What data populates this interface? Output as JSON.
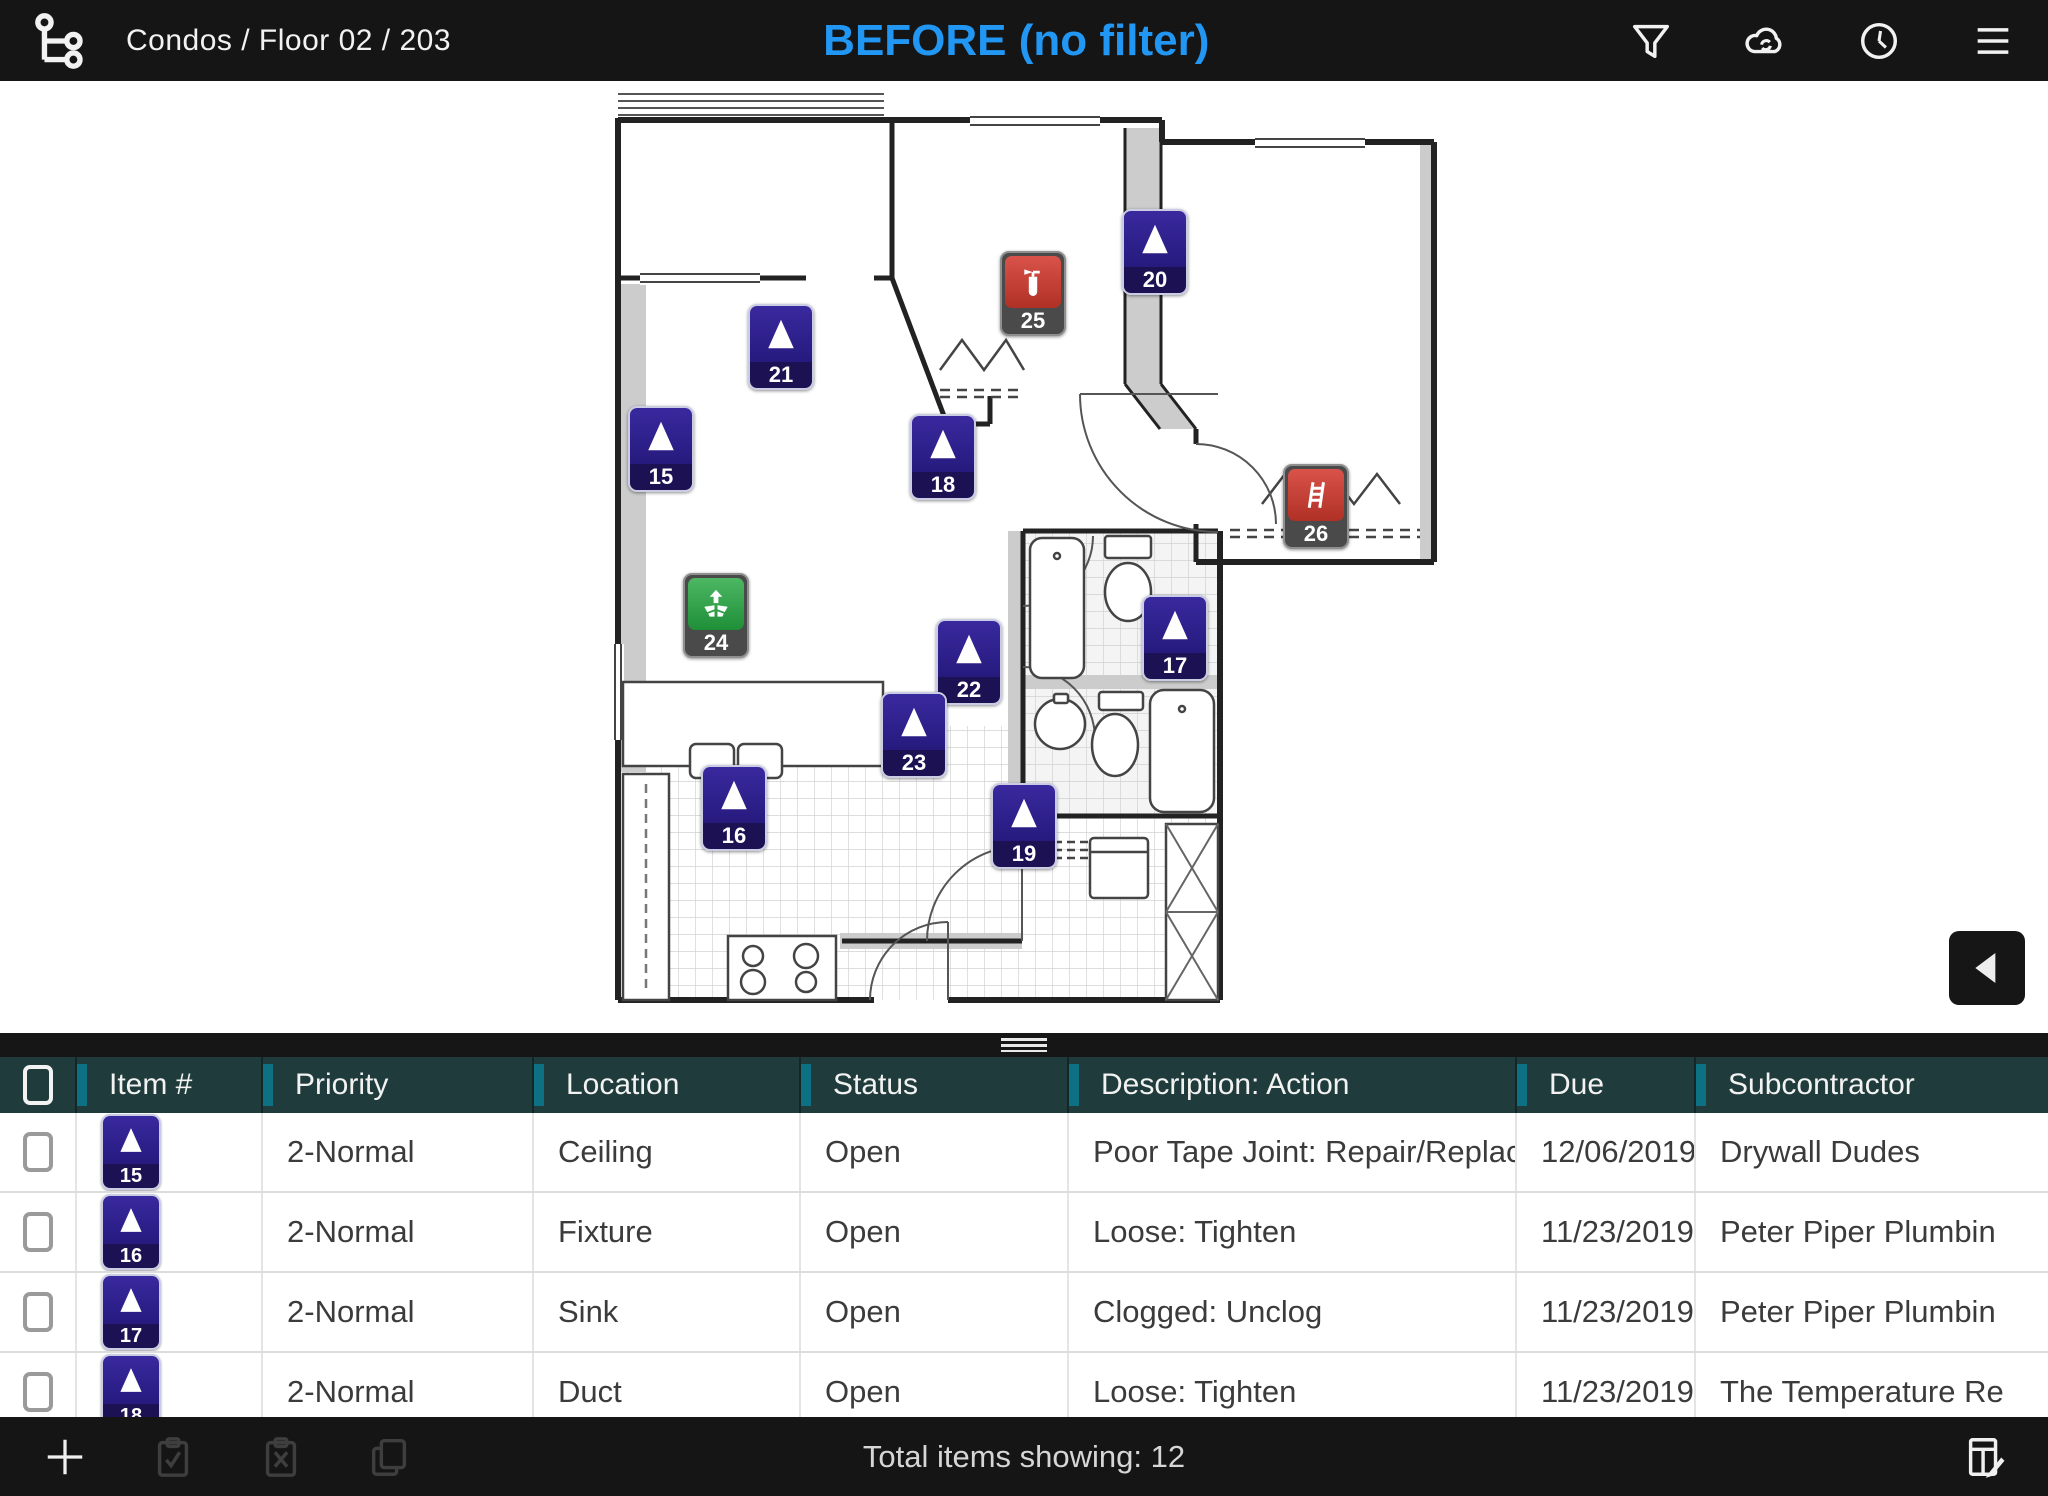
{
  "header": {
    "breadcrumb": "Condos / Floor 02 / 203",
    "title": "BEFORE (no filter)",
    "icons": [
      "hierarchy-icon",
      "filter-icon",
      "cloud-sync-icon",
      "history-icon",
      "menu-icon"
    ]
  },
  "colors": {
    "accent": "#2196f3",
    "header_bg": "#1f3b3b",
    "header_accent": "#0e7183",
    "navy": "#39299e",
    "navy_band": "#1b1153",
    "red": "#b03025",
    "green": "#1f8f38",
    "band_gray": "#4a4a4a"
  },
  "plan": {
    "markers": [
      {
        "num": "20",
        "type": "issue",
        "x": 1155,
        "y": 250
      },
      {
        "num": "25",
        "type": "extinguisher",
        "x": 1033,
        "y": 292
      },
      {
        "num": "21",
        "type": "issue",
        "x": 781,
        "y": 345
      },
      {
        "num": "15",
        "type": "issue",
        "x": 661,
        "y": 447
      },
      {
        "num": "18",
        "type": "issue",
        "x": 943,
        "y": 455
      },
      {
        "num": "26",
        "type": "ladder",
        "x": 1316,
        "y": 505
      },
      {
        "num": "24",
        "type": "supply",
        "x": 716,
        "y": 614
      },
      {
        "num": "17",
        "type": "issue",
        "x": 1175,
        "y": 636
      },
      {
        "num": "22",
        "type": "issue",
        "x": 969,
        "y": 660
      },
      {
        "num": "23",
        "type": "issue",
        "x": 914,
        "y": 733
      },
      {
        "num": "16",
        "type": "issue",
        "x": 734,
        "y": 806
      },
      {
        "num": "19",
        "type": "issue",
        "x": 1024,
        "y": 824
      }
    ]
  },
  "table": {
    "columns": [
      {
        "id": "check",
        "label": ""
      },
      {
        "id": "item",
        "label": "Item #"
      },
      {
        "id": "priority",
        "label": "Priority"
      },
      {
        "id": "location",
        "label": "Location"
      },
      {
        "id": "status",
        "label": "Status"
      },
      {
        "id": "desc",
        "label": "Description: Action"
      },
      {
        "id": "due",
        "label": "Due"
      },
      {
        "id": "sub",
        "label": "Subcontractor"
      }
    ],
    "rows": [
      {
        "num": "15",
        "type": "issue",
        "priority": "2-Normal",
        "location": "Ceiling",
        "status": "Open",
        "description": "Poor Tape Joint: Repair/Replace",
        "due": "12/06/2019 (",
        "subcontractor": "Drywall Dudes",
        "checked": false
      },
      {
        "num": "16",
        "type": "issue",
        "priority": "2-Normal",
        "location": "Fixture",
        "status": "Open",
        "description": "Loose: Tighten",
        "due": "11/23/2019",
        "subcontractor": "Peter Piper Plumbin",
        "checked": false
      },
      {
        "num": "17",
        "type": "issue",
        "priority": "2-Normal",
        "location": "Sink",
        "status": "Open",
        "description": "Clogged: Unclog",
        "due": "11/23/2019",
        "subcontractor": "Peter Piper Plumbin",
        "checked": false
      },
      {
        "num": "18",
        "type": "issue",
        "priority": "2-Normal",
        "location": "Duct",
        "status": "Open",
        "description": "Loose: Tighten",
        "due": "11/23/2019",
        "subcontractor": "The Temperature Re",
        "checked": false
      }
    ]
  },
  "footer": {
    "total_text": "Total items showing: 12"
  }
}
